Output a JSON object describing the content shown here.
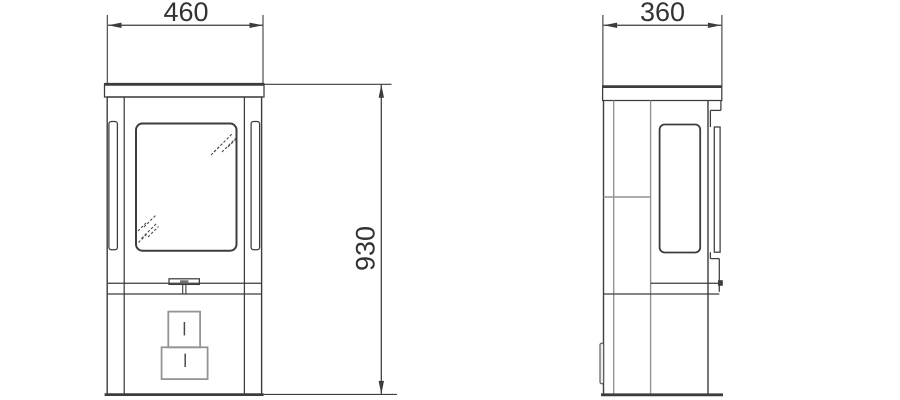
{
  "drawing": {
    "dimensions": {
      "front_width": {
        "value": "460"
      },
      "side_depth": {
        "value": "360"
      },
      "height": {
        "value": "930"
      }
    }
  },
  "colors": {
    "line_dark": "#3c3c3c",
    "line_mid": "#949494",
    "text": "#333333",
    "background": "#ffffff"
  }
}
